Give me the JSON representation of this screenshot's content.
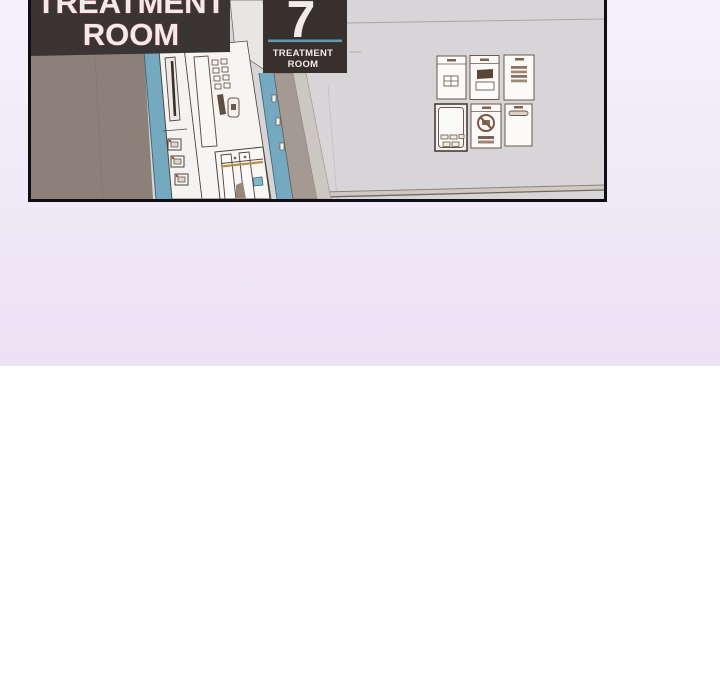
{
  "page": {
    "type": "comic-viewer",
    "background_top_color": "#f3edfa",
    "background_bottom_color": "#ffffff"
  },
  "comic_panel": {
    "border_color": "#0f0e15",
    "signs": {
      "large_sign": {
        "line1": "TREATMENT",
        "line2": "ROOM",
        "bg": "#3a3434",
        "text_color": "#f3eaeb",
        "outline_color": "#8d4046"
      },
      "room_number_sign": {
        "number": "7",
        "line1": "TREATMENT",
        "line2": "ROOM",
        "bg": "#37302c",
        "text_color": "#f3eaeb",
        "divider_color": "#5e9ab3"
      }
    },
    "scene": {
      "description": "hospital corridor with treatment room doors",
      "wall_left_color": "#8c8078",
      "wall_right_color": "#d7d5d8",
      "door_frame_color": "#74a9bf",
      "lineart_color": "#5d4a3c",
      "posters": [
        {
          "name": "notice-with-grid"
        },
        {
          "name": "notice-with-picture"
        },
        {
          "name": "notice-with-text-lines"
        },
        {
          "name": "intercom-device"
        },
        {
          "name": "no-smoking-notice"
        },
        {
          "name": "label-strip-notice"
        }
      ]
    }
  },
  "colors": {
    "lavender_top": "#f6f1fb",
    "lavender_mid": "#efe8f7",
    "lavender_bottom": "#ebe2f5",
    "page_white": "#ffffff",
    "panel_border": "#0f0e15",
    "wall_gray": "#d7d5d8",
    "wall_taupe": "#8c8078",
    "teal": "#74a9bf",
    "teal_dark": "#2e5260",
    "teal_divider": "#5e9ab3",
    "line_brown": "#5d4a3c",
    "poster_line": "#6d5847",
    "poster_fill": "#fbfaf8",
    "sign_bg": "#3a3434",
    "sign7_bg": "#37302c",
    "sign_text": "#f3eaeb",
    "sign_outline": "#8d4046",
    "baseboard": "#cfc9c2",
    "strip_taupe": "#a49a91",
    "strip_light": "#cdc7c1"
  }
}
